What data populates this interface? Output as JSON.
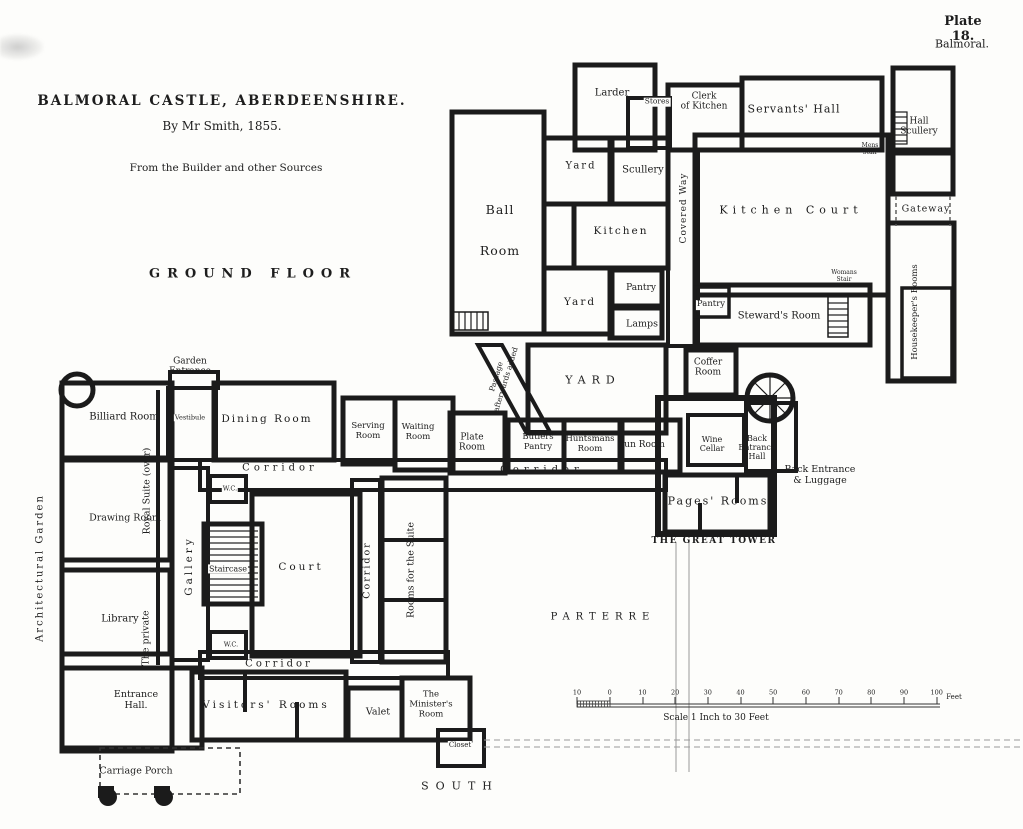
{
  "plate": {
    "number": "Plate 18.",
    "location": "Balmoral."
  },
  "title_block": {
    "title": "BALMORAL CASTLE, ABERDEENSHIRE.",
    "byline": "By Mr Smith, 1855.",
    "source": "From the Builder and other Sources",
    "floor": "GROUND FLOOR"
  },
  "scale_bar": {
    "tick_labels": [
      "10",
      "0",
      "10",
      "20",
      "30",
      "40",
      "50",
      "60",
      "70",
      "80",
      "90",
      "100"
    ],
    "unit": "Feet",
    "caption": "Scale 1 Inch to 30 Feet"
  },
  "labels": [
    {
      "n": "larder",
      "t": "Larder",
      "x": 612,
      "y": 93,
      "s": 10
    },
    {
      "n": "stores",
      "t": "Stores",
      "x": 657,
      "y": 102,
      "s": 7.5,
      "bg": 1
    },
    {
      "n": "clerk-of-kitchen",
      "t": "Clerk\nof Kitchen",
      "x": 704,
      "y": 102,
      "s": 9
    },
    {
      "n": "servants-hall",
      "t": "Servants' Hall",
      "x": 794,
      "y": 110,
      "s": 11,
      "sp": 1
    },
    {
      "n": "hall-scullery",
      "t": "Hall\nScullery",
      "x": 919,
      "y": 127,
      "s": 9
    },
    {
      "n": "mens-stair",
      "t": "Mens\nStair",
      "x": 870,
      "y": 150,
      "s": 6
    },
    {
      "n": "gateway",
      "t": "Gateway",
      "x": 926,
      "y": 210,
      "s": 9.5,
      "sp": 1
    },
    {
      "n": "housekeepers-rooms",
      "t": "Housekeeper's Rooms",
      "x": 916,
      "y": 312,
      "s": 8.5,
      "r": -90
    },
    {
      "n": "kitchen-court",
      "t": "Kitchen Court",
      "x": 791,
      "y": 211,
      "s": 11,
      "sp": 5
    },
    {
      "n": "covered-way",
      "t": "Covered Way",
      "x": 684,
      "y": 208,
      "s": 9,
      "sp": 1,
      "r": -90
    },
    {
      "n": "womans-stair",
      "t": "Womans\nStair",
      "x": 844,
      "y": 277,
      "s": 6
    },
    {
      "n": "pantry-stewards",
      "t": "Pantry",
      "x": 711,
      "y": 305,
      "s": 8.5,
      "bg": 1
    },
    {
      "n": "stewards-room",
      "t": "Steward's Room",
      "x": 779,
      "y": 316,
      "s": 10
    },
    {
      "n": "ball-room",
      "t": "Ball\nRoom",
      "x": 500,
      "y": 230,
      "s": 12.5,
      "sp": 1,
      "lh": 3.3
    },
    {
      "n": "yard-upper",
      "t": "Yard",
      "x": 581,
      "y": 166,
      "s": 10,
      "sp": 2
    },
    {
      "n": "scullery",
      "t": "Scullery",
      "x": 643,
      "y": 170,
      "s": 10
    },
    {
      "n": "kitchen",
      "t": "Kitchen",
      "x": 621,
      "y": 231,
      "s": 10.5,
      "sp": 2
    },
    {
      "n": "yard-lower",
      "t": "Yard",
      "x": 580,
      "y": 302,
      "s": 10.5,
      "sp": 2
    },
    {
      "n": "pantry-kitchen",
      "t": "Pantry",
      "x": 641,
      "y": 288,
      "s": 9
    },
    {
      "n": "lamps",
      "t": "Lamps",
      "x": 642,
      "y": 325,
      "s": 9.5
    },
    {
      "n": "yard-middle",
      "t": "YARD",
      "x": 593,
      "y": 381,
      "s": 11,
      "sp": 6
    },
    {
      "n": "passage-afterwards-added",
      "t": "Passage\nafterwards added",
      "x": 501,
      "y": 378,
      "s": 7.5,
      "r": -73,
      "lh": 1.3
    },
    {
      "n": "coffer-room",
      "t": "Coffer\nRoom",
      "x": 708,
      "y": 368,
      "s": 9
    },
    {
      "n": "serving-room",
      "t": "Serving\nRoom",
      "x": 368,
      "y": 432,
      "s": 8.5
    },
    {
      "n": "waiting-room",
      "t": "Waiting\nRoom",
      "x": 418,
      "y": 433,
      "s": 8.5
    },
    {
      "n": "plate-room",
      "t": "Plate\nRoom",
      "x": 472,
      "y": 443,
      "s": 9
    },
    {
      "n": "butlers-pantry",
      "t": "Butlers\nPantry",
      "x": 538,
      "y": 443,
      "s": 8.5
    },
    {
      "n": "huntsmans-room",
      "t": "Huntsmans\nRoom",
      "x": 590,
      "y": 445,
      "s": 8.5
    },
    {
      "n": "gun-room",
      "t": "Gun Room",
      "x": 641,
      "y": 445,
      "s": 9
    },
    {
      "n": "wine-cellar",
      "t": "Wine\nCellar",
      "x": 712,
      "y": 444,
      "s": 8,
      "bg": 1
    },
    {
      "n": "back-entrance-hall",
      "t": "Back\nEntrance\nHall",
      "x": 757,
      "y": 448,
      "s": 8
    },
    {
      "n": "back-entrance-luggage",
      "t": "Back Entrance\n& Luggage",
      "x": 820,
      "y": 476,
      "s": 9.5
    },
    {
      "n": "pages-rooms",
      "t": "Pages' Rooms",
      "x": 718,
      "y": 502,
      "s": 11,
      "sp": 2
    },
    {
      "n": "the-great-tower",
      "t": "THE GREAT TOWER",
      "x": 714,
      "y": 541,
      "s": 9,
      "b": 1,
      "sp": 1.5
    },
    {
      "n": "garden-entrance",
      "t": "Garden\nEntrance",
      "x": 190,
      "y": 367,
      "s": 9
    },
    {
      "n": "billiard-room",
      "t": "Billiard Room",
      "x": 124,
      "y": 417,
      "s": 10
    },
    {
      "n": "vestibule",
      "t": "Vestibule",
      "x": 190,
      "y": 418,
      "s": 6.5,
      "bg": 1
    },
    {
      "n": "dining-room",
      "t": "Dining Room",
      "x": 267,
      "y": 419,
      "s": 10.5,
      "sp": 2
    },
    {
      "n": "corridor-upper-left",
      "t": "Corridor",
      "x": 280,
      "y": 468,
      "s": 10,
      "sp": 4
    },
    {
      "n": "corridor-main",
      "t": "Corridor",
      "x": 542,
      "y": 470,
      "s": 10,
      "sp": 5
    },
    {
      "n": "royal-suite-over",
      "t": "Royal Suite (over)",
      "x": 148,
      "y": 491,
      "s": 9.5,
      "r": -90
    },
    {
      "n": "the-private",
      "t": "The private",
      "x": 147,
      "y": 638,
      "s": 9.5,
      "r": -90
    },
    {
      "n": "drawing-room",
      "t": "Drawing Room",
      "x": 125,
      "y": 519,
      "s": 9.5
    },
    {
      "n": "library",
      "t": "Library",
      "x": 120,
      "y": 619,
      "s": 10
    },
    {
      "n": "gallery",
      "t": "Gallery",
      "x": 189,
      "y": 566,
      "s": 10.5,
      "sp": 3,
      "r": -90
    },
    {
      "n": "wc-upper",
      "t": "W.C.",
      "x": 230,
      "y": 489,
      "s": 6.5,
      "bg": 1
    },
    {
      "n": "wc-lower",
      "t": "W.C.",
      "x": 231,
      "y": 645,
      "s": 6.5,
      "bg": 1
    },
    {
      "n": "staircase",
      "t": "Staircase",
      "x": 228,
      "y": 569,
      "s": 8,
      "bg": 1
    },
    {
      "n": "court",
      "t": "Court",
      "x": 301,
      "y": 567,
      "s": 10.5,
      "sp": 3
    },
    {
      "n": "corridor-court",
      "t": "Corridor",
      "x": 368,
      "y": 570,
      "s": 9.5,
      "sp": 2,
      "r": -90
    },
    {
      "n": "rooms-for-the-suite",
      "t": "Rooms for the Suite",
      "x": 412,
      "y": 570,
      "s": 9.5,
      "r": -90
    },
    {
      "n": "corridor-bottom",
      "t": "Corridor",
      "x": 279,
      "y": 664,
      "s": 10,
      "sp": 3
    },
    {
      "n": "entrance-hall",
      "t": "Entrance\nHall.",
      "x": 136,
      "y": 701,
      "s": 9.5
    },
    {
      "n": "visitors-rooms",
      "t": "Visitors' Rooms",
      "x": 266,
      "y": 705,
      "s": 10.5,
      "sp": 3
    },
    {
      "n": "valet",
      "t": "Valet",
      "x": 378,
      "y": 713,
      "s": 9.5
    },
    {
      "n": "ministers-room",
      "t": "The\nMinister's\nRoom",
      "x": 431,
      "y": 705,
      "s": 8.5
    },
    {
      "n": "closet",
      "t": "Closet",
      "x": 460,
      "y": 745,
      "s": 7,
      "bg": 1
    },
    {
      "n": "carriage-porch",
      "t": "Carriage Porch",
      "x": 136,
      "y": 772,
      "s": 9.5
    },
    {
      "n": "south",
      "t": "SOUTH",
      "x": 460,
      "y": 787,
      "s": 11,
      "sp": 7
    },
    {
      "n": "architectural-garden",
      "t": "Architectural Garden",
      "x": 40,
      "y": 568,
      "s": 10,
      "sp": 2,
      "r": -90
    },
    {
      "n": "parterre",
      "t": "PARTERRE",
      "x": 603,
      "y": 617,
      "s": 10,
      "sp": 6
    }
  ]
}
